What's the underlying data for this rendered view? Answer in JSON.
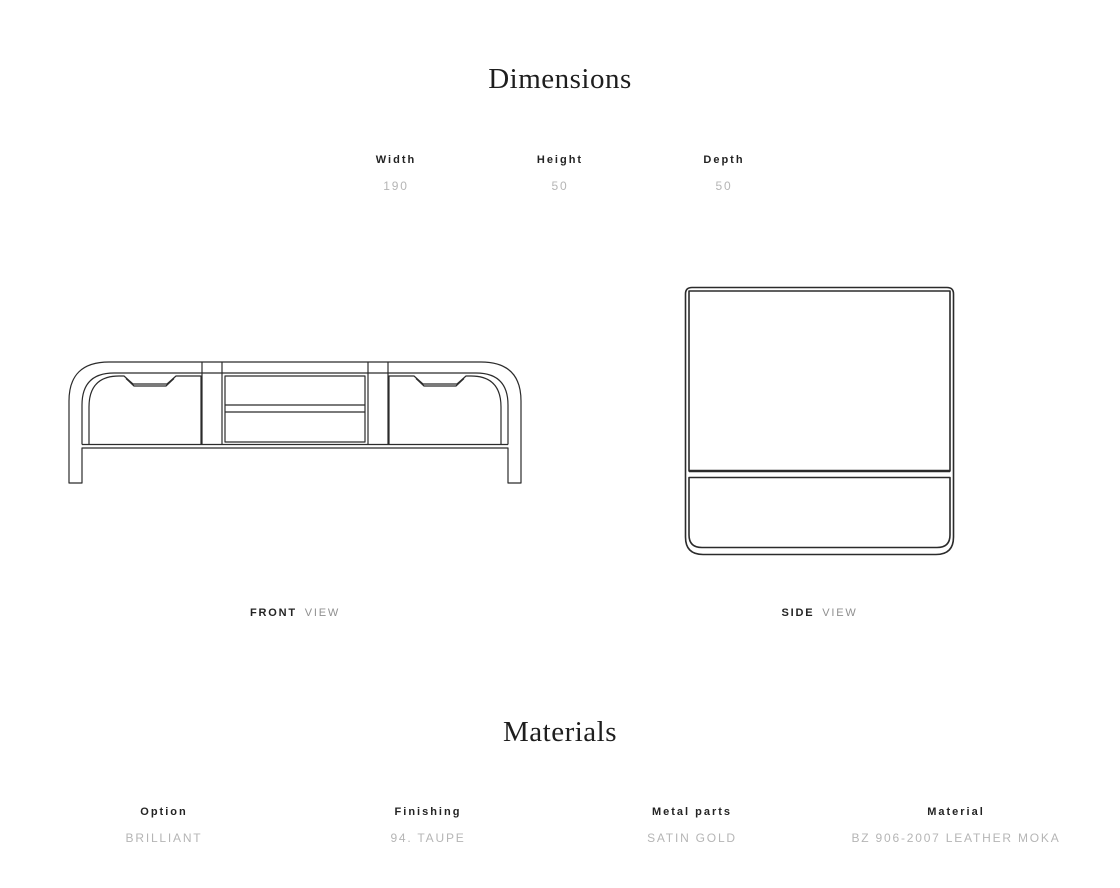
{
  "dimensions_section": {
    "title": "Dimensions",
    "columns": [
      {
        "label": "Width",
        "value": "190"
      },
      {
        "label": "Height",
        "value": "50"
      },
      {
        "label": "Depth",
        "value": "50"
      }
    ]
  },
  "views": {
    "front": {
      "name": "FRONT",
      "suffix": "VIEW"
    },
    "side": {
      "name": "SIDE",
      "suffix": "VIEW"
    }
  },
  "materials_section": {
    "title": "Materials",
    "columns": [
      {
        "label": "Option",
        "value": "BRILLIANT"
      },
      {
        "label": "Finishing",
        "value": "94. TAUPE"
      },
      {
        "label": "Metal parts",
        "value": "SATIN GOLD"
      },
      {
        "label": "Material",
        "value": "BZ 906-2007 LEATHER MOKA"
      }
    ]
  },
  "icons": {
    "front_drawing": "front-elevation-line-drawing",
    "side_drawing": "side-elevation-line-drawing"
  },
  "colors": {
    "background": "#ffffff",
    "heading": "#1e1e1e",
    "label": "#232323",
    "value": "#b5b5b5",
    "caption_muted": "#8f8f8f",
    "line": "#2b2b2b"
  }
}
